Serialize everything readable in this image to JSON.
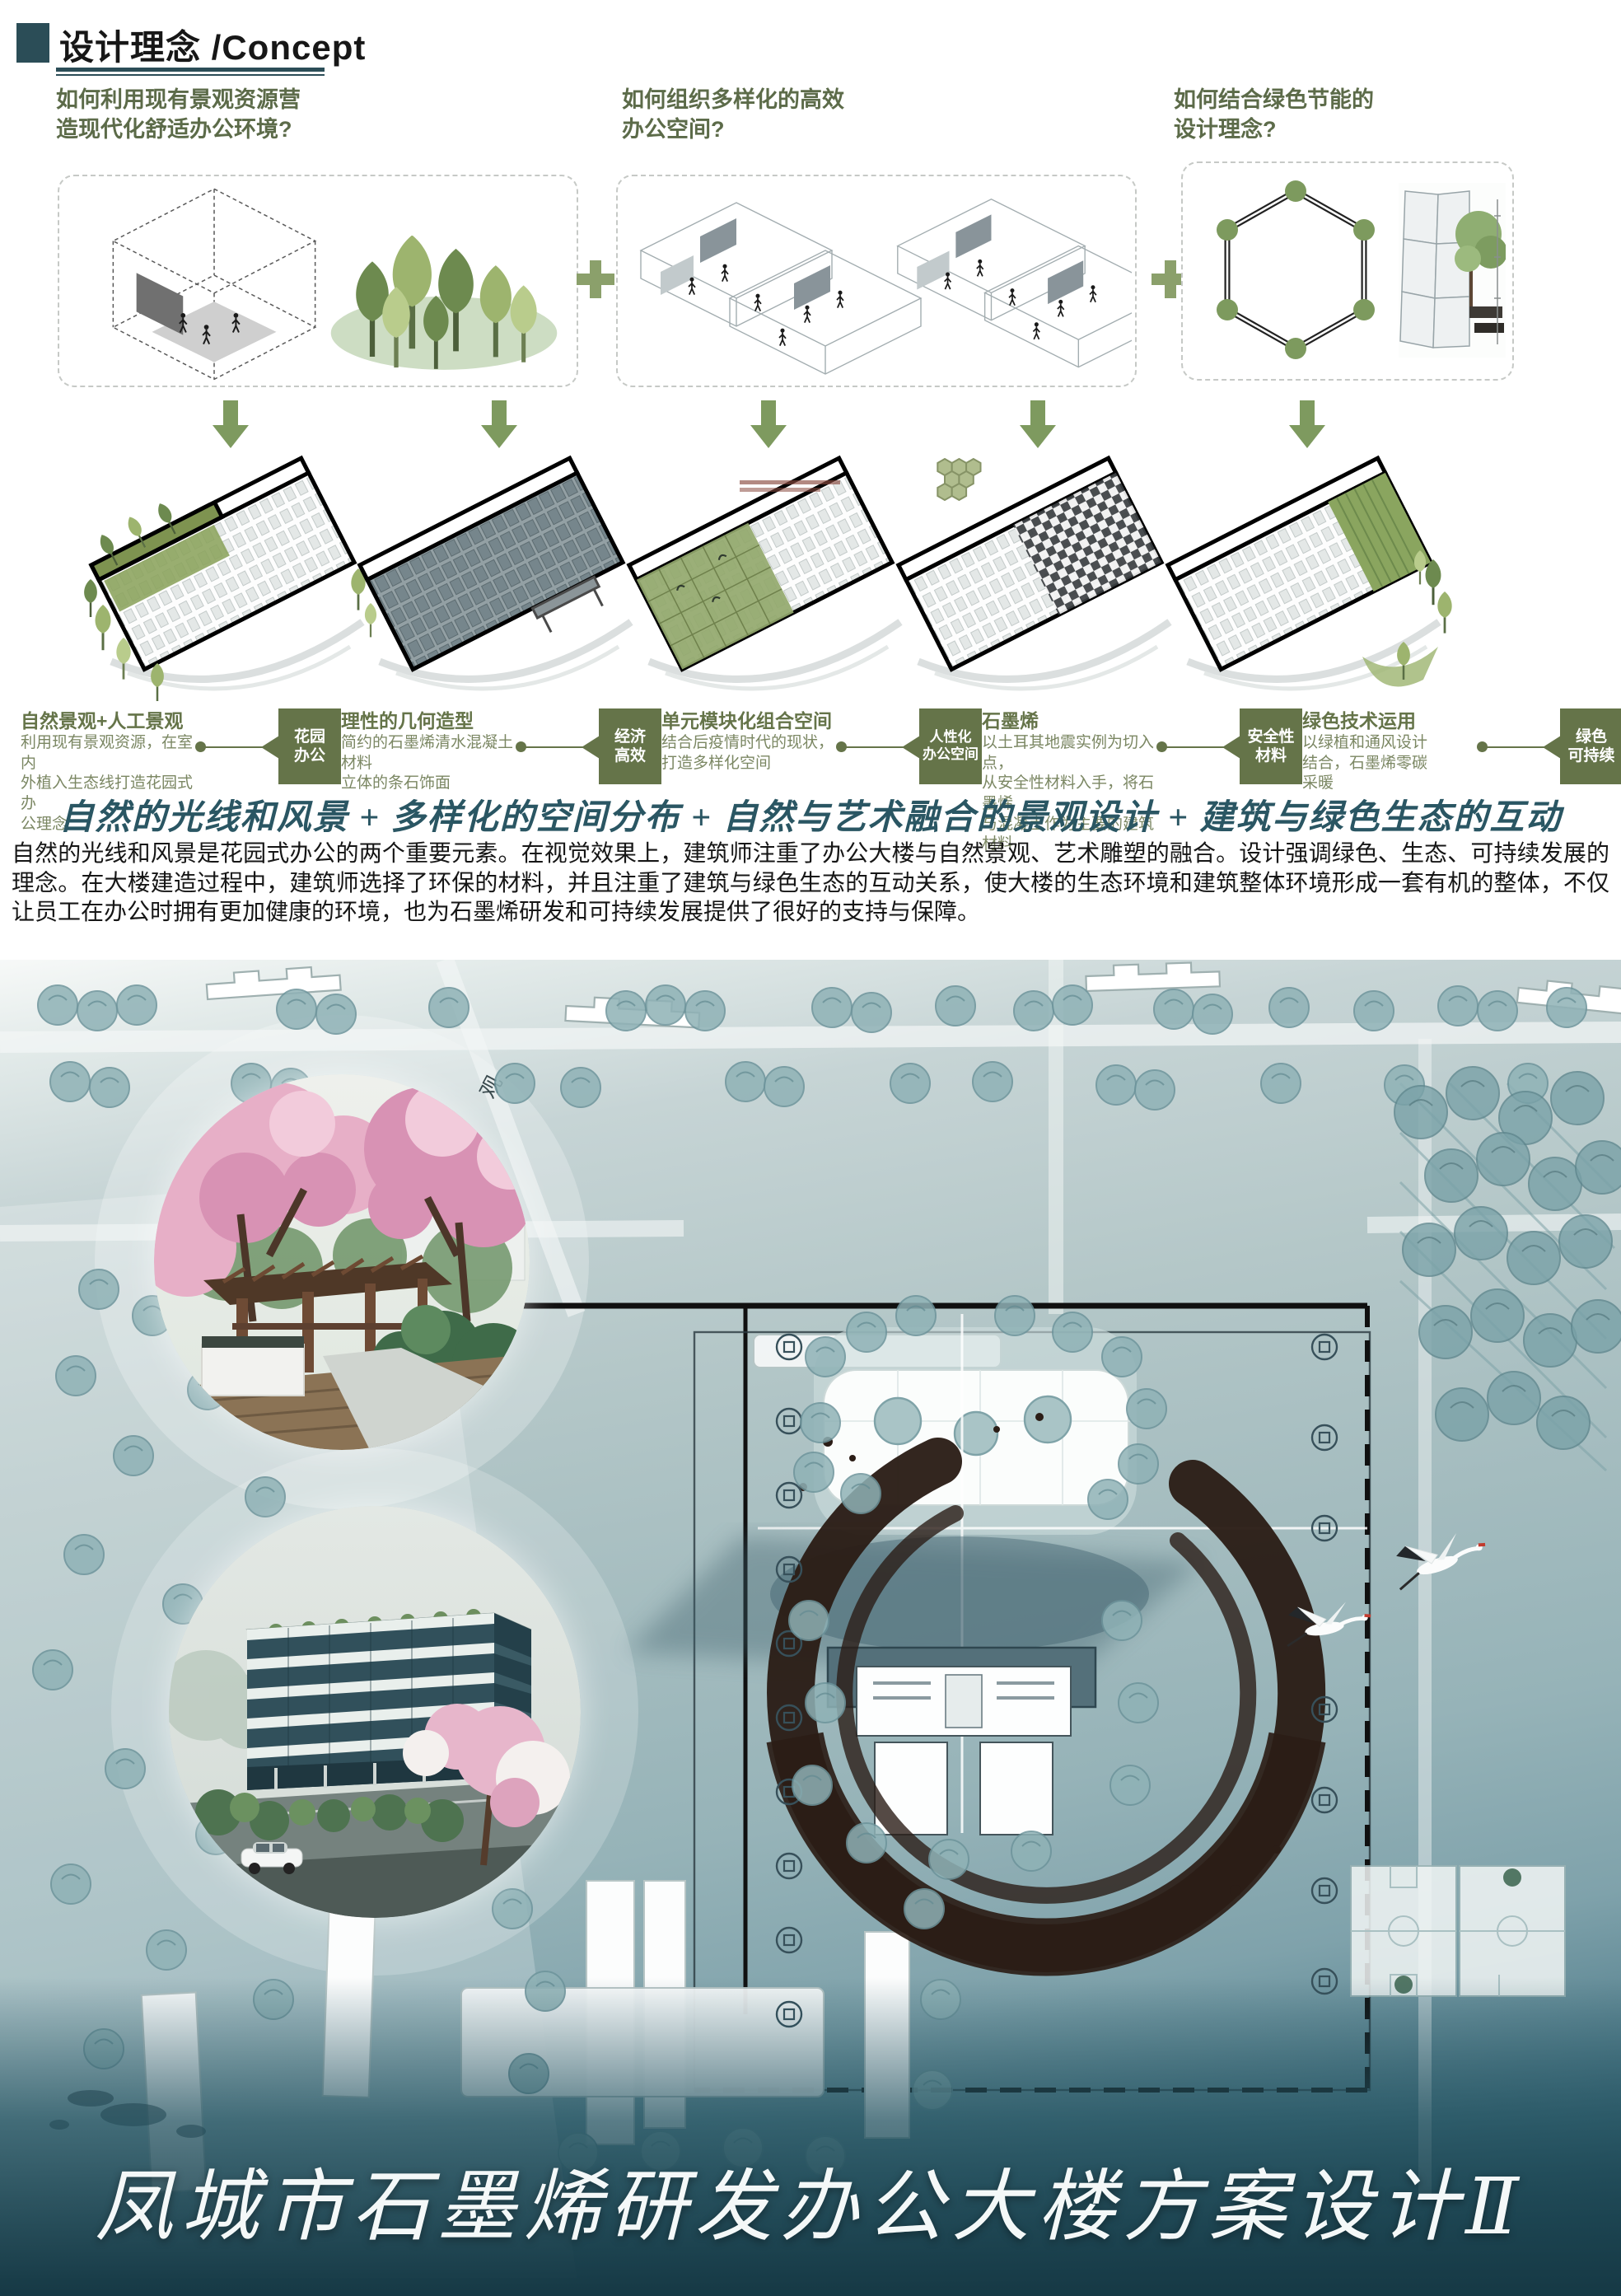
{
  "poster": {
    "header": {
      "title": "设计理念 /Concept"
    },
    "questions": [
      {
        "text": "如何利用现有景观资源营\n造现代化舒适办公环境?"
      },
      {
        "text": "如何组织多样化的高效\n办公空间?"
      },
      {
        "text": "如何结合绿色节能的\n设计理念?"
      }
    ],
    "concepts": [
      {
        "heading": "自然景观+人工景观",
        "body": "利用现有景观资源，在室内\n外植入生态线打造花园式办\n公理念",
        "badge": "花园\n办公"
      },
      {
        "heading": "理性的几何造型",
        "body": "简约的石墨烯清水混凝土材料\n立体的条石饰面",
        "badge": "经济\n高效"
      },
      {
        "heading": "单元模块化组合空间",
        "body": "结合后疫情时代的现状，\n打造多样化空间",
        "badge": "人性化\n办公空间"
      },
      {
        "heading": "石墨烯",
        "body": "以土耳其地震实例为切入点，\n从安全性材料入手，将石墨烯\n与混凝土作为主要的建筑材料",
        "badge": "安全性\n材料"
      },
      {
        "heading": "绿色技术运用",
        "body": "以绿植和通风设计\n结合，石墨烯零碳\n采暖",
        "badge": "绿色\n可持续"
      }
    ],
    "formula": "自然的光线和风景 + 多样化的空间分布 + 自然与艺术融合的景观设计 + 建筑与绿色生态的互动",
    "paragraph": "自然的光线和风景是花园式办公的两个重要元素。在视觉效果上，建筑师注重了办公大楼与自然景观、艺术雕塑的融合。设计强调绿色、生态、可持续发展的理念。在大楼建造过程中，建筑师选择了环保的材料，并且注重了建筑与绿色生态的互动关系，使大楼的生态环境和建筑整体环境形成一套有机的整体，不仅让员工在办公时拥有更加健康的环境，也为石墨烯研发和可持续发展提供了很好的支持与保障。",
    "road_label": "观",
    "footer_title": "凤城市石墨烯研发办公大楼方案设计Ⅱ",
    "icons": {
      "plus_icon": "+",
      "down_arrow_icon": "↓",
      "hexagon_molecule_icon": "⬡"
    },
    "colors": {
      "accent_teal": "#2b4d57",
      "question_green": "#5c6b49",
      "badge_green": "#657449",
      "diagram_green": "#7e9a5f",
      "handwriting_teal": "#2a5663",
      "ink": "#2b1d16",
      "footer_bg": "#163945"
    }
  }
}
